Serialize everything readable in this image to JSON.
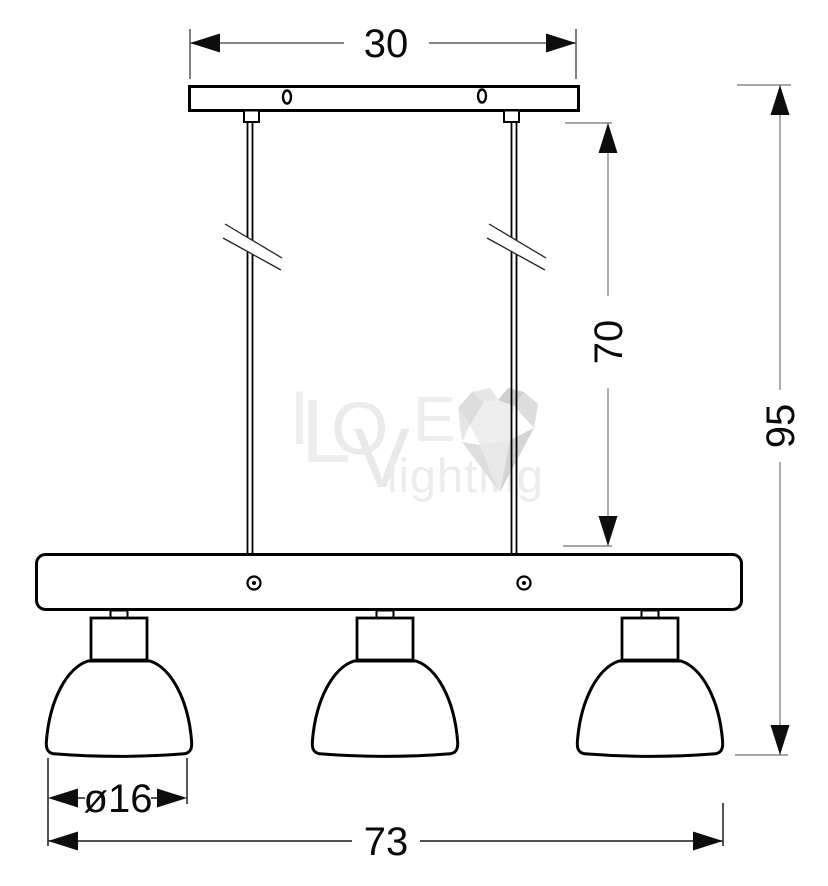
{
  "drawing": {
    "type": "pendant-lamp-technical-drawing",
    "dimensions": {
      "canopy_width": {
        "label": "30"
      },
      "rod_length": {
        "label": "70"
      },
      "total_height": {
        "label": "95"
      },
      "shade_diameter": {
        "label": "ø16"
      },
      "fixture_width": {
        "label": "73"
      }
    },
    "watermark": {
      "letters": [
        "I",
        "L",
        "O",
        "V",
        "E"
      ],
      "word2": "lighting",
      "color": "#ebebeb"
    },
    "colors": {
      "outline": "#000000",
      "dimension_line_gray": "#8a8a8a",
      "dimension_line_black": "#1c1c1c",
      "arrow": "#0d0d0d",
      "background": "#ffffff"
    }
  }
}
